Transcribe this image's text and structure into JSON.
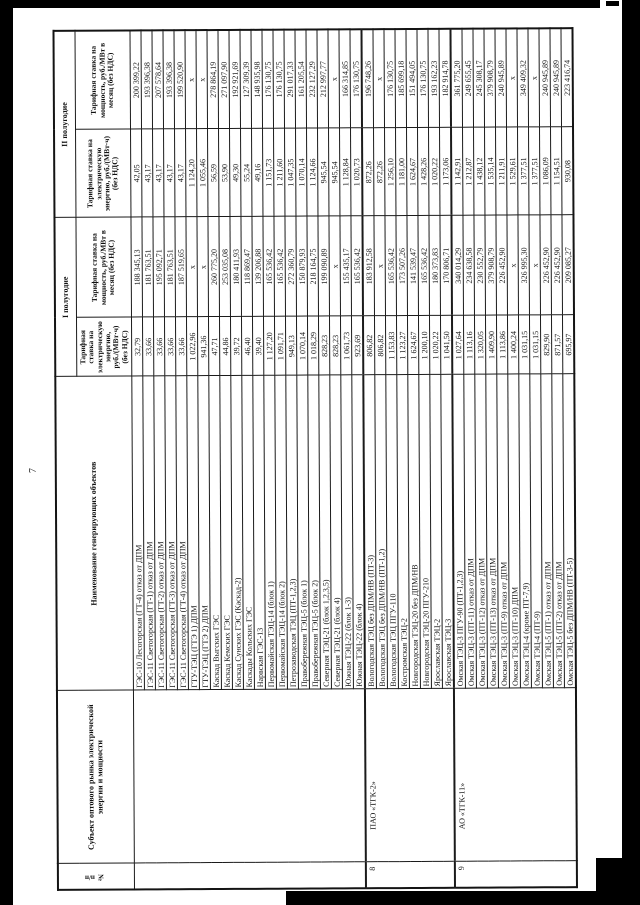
{
  "page": {
    "number": "7"
  },
  "colors": {
    "paper": "#ffffff",
    "ink": "#1b1b1b",
    "scan_edge": "#000000"
  },
  "table": {
    "headers": {
      "num": "№ п/п",
      "subject": "Субъект оптового рынка электрической энергии и мощности",
      "object": "Наименование генерирующих объектов",
      "half1": "I полугодие",
      "half2": "II полугодие",
      "energy_rate": "Тарифная ставка на электрическую энергию, руб./(МВт·ч) (без НДС)",
      "capacity_rate": "Тарифная ставка на мощность, руб./МВт в месяц (без НДС)"
    },
    "groups": [
      {
        "num": "",
        "subject": "",
        "rows": [
          {
            "name": "ГЭС-10 Лесогорская (ГТ-4) отказ от ДПМ",
            "e1": "32,79",
            "c1": "188 345,13",
            "e2": "42,05",
            "c2": "200 399,22"
          },
          {
            "name": "ГЭС-11 Светогорская (ГТ-1) отказ от ДПМ",
            "e1": "33,66",
            "c1": "181 763,51",
            "e2": "43,17",
            "c2": "193 396,38"
          },
          {
            "name": "ГЭС-11 Светогорская (ГТ-2) отказ от ДПМ",
            "e1": "33,66",
            "c1": "195 092,71",
            "e2": "43,17",
            "c2": "207 578,64"
          },
          {
            "name": "ГЭС-11 Светогорская (ГТ-3) отказ от ДПМ",
            "e1": "33,66",
            "c1": "181 763,51",
            "e2": "43,17",
            "c2": "193 396,38"
          },
          {
            "name": "ГЭС-11 Светогорская (ГТ-4) отказ от ДПМ",
            "e1": "33,66",
            "c1": "187 519,65",
            "e2": "43,17",
            "c2": "199 520,90"
          },
          {
            "name": "ГТУ-ТЭЦ (ГТЭ 1) ДПМ",
            "e1": "1 022,96",
            "c1": "х",
            "e2": "1 124,20",
            "c2": "х"
          },
          {
            "name": "ГТУ-ТЭЦ (ГТЭ 2) ДПМ",
            "e1": "941,36",
            "c1": "х",
            "e2": "1 055,46",
            "c2": "х"
          },
          {
            "name": "Каскад Выгских ГЭС",
            "e1": "47,71",
            "c1": "260 775,20",
            "e2": "56,59",
            "c2": "278 864,19"
          },
          {
            "name": "Каскад Кемских ГЭС",
            "e1": "44,86",
            "c1": "253 035,08",
            "e2": "53,90",
            "c2": "271 097,90"
          },
          {
            "name": "Каскад Сунских ГЭС (Каскад-2)",
            "e1": "39,72",
            "c1": "180 411,93",
            "e2": "49,30",
            "c2": "192 921,69"
          },
          {
            "name": "Каскады Кольских ГЭС",
            "e1": "46,40",
            "c1": "118 869,47",
            "e2": "55,24",
            "c2": "127 309,39"
          },
          {
            "name": "Нарвская ГЭС-13",
            "e1": "39,40",
            "c1": "139 206,88",
            "e2": "49,16",
            "c2": "148 935,98"
          },
          {
            "name": "Первомайская ТЭЦ-14 (блок 1)",
            "e1": "1 127,20",
            "c1": "165 536,42",
            "e2": "1 151,73",
            "c2": "176 130,75"
          },
          {
            "name": "Первомайская ТЭЦ-14 (блок 2)",
            "e1": "1 091,71",
            "c1": "165 536,42",
            "e2": "1 211,60",
            "c2": "176 130,75"
          },
          {
            "name": "Петрозаводская ТЭЦ (ПТ-1,2,3)",
            "e1": "949,13",
            "c1": "272 360,79",
            "e2": "1 047,35",
            "c2": "291 017,33"
          },
          {
            "name": "Правобережная ТЭЦ-5 (блок 1)",
            "e1": "1 070,14",
            "c1": "150 879,93",
            "e2": "1 070,14",
            "c2": "161 205,54"
          },
          {
            "name": "Правобережная ТЭЦ-5 (блок 2)",
            "e1": "1 018,29",
            "c1": "218 164,75",
            "e2": "1 124,66",
            "c2": "232 127,29"
          },
          {
            "name": "Северная ТЭЦ-21 (блок 1,2,3,5)",
            "e1": "828,23",
            "c1": "199 090,89",
            "e2": "945,54",
            "c2": "212 997,77"
          },
          {
            "name": "Северная ТЭЦ-21 (блок 4)",
            "e1": "828,23",
            "c1": "х",
            "e2": "945,54",
            "c2": "х"
          },
          {
            "name": "Южная ТЭЦ-22 (блок 1-3)",
            "e1": "1 061,73",
            "c1": "155 435,17",
            "e2": "1 128,84",
            "c2": "166 314,85"
          },
          {
            "name": "Южная ТЭЦ-22 (блок 4)",
            "e1": "923,69",
            "c1": "165 536,42",
            "e2": "1 020,73",
            "c2": "176 130,75"
          }
        ]
      },
      {
        "num": "8",
        "subject": "ПАО «ТГК-2»",
        "rows": [
          {
            "name": "Вологодская ТЭЦ без ДПМ/НВ (ПТ-3)",
            "e1": "806,82",
            "c1": "183 912,58",
            "e2": "872,26",
            "c2": "196 748,26"
          },
          {
            "name": "Вологодская ТЭЦ без ДПМ/НВ (ПТ-1,2)",
            "e1": "806,82",
            "c1": "х",
            "e2": "872,26",
            "c2": "х"
          },
          {
            "name": "Вологодская ТЭЦ ПГУ-110",
            "e1": "1 153,83",
            "c1": "165 536,42",
            "e2": "1 256,10",
            "c2": "176 130,75"
          },
          {
            "name": "Костромская ТЭЦ-2",
            "e1": "1 123,27",
            "c1": "173 507,26",
            "e2": "1 181,00",
            "c2": "185 699,18"
          },
          {
            "name": "Новгородская ТЭЦ-20 без ДПМ/НВ",
            "e1": "1 624,67",
            "c1": "141 539,47",
            "e2": "1 624,67",
            "c2": "151 494,05"
          },
          {
            "name": "Новгородская ТЭЦ-20 ПГУ-210",
            "e1": "1 200,10",
            "c1": "165 536,42",
            "e2": "1 428,26",
            "c2": "176 130,75"
          },
          {
            "name": "Ярославская ТЭЦ-2",
            "e1": "1 020,22",
            "c1": "180 373,83",
            "e2": "1 020,22",
            "c2": "193 162,23"
          },
          {
            "name": "Ярославская ТЭЦ-3",
            "e1": "1 041,50",
            "c1": "170 806,71",
            "e2": "1 173,06",
            "c2": "182 914,78"
          }
        ]
      },
      {
        "num": "9",
        "subject": "АО «ТГК-11»",
        "rows": [
          {
            "name": "Омская ТЭЦ-3 ПГУ-90 (ПТ-1,2,3)",
            "e1": "1 027,64",
            "c1": "340 014,29",
            "e2": "1 142,91",
            "c2": "361 775,20"
          },
          {
            "name": "Омская ТЭЦ-3 (ПТ-11) отказ от ДПМ",
            "e1": "1 113,16",
            "c1": "234 638,58",
            "e2": "1 212,87",
            "c2": "249 655,45"
          },
          {
            "name": "Омская ТЭЦ-3 (ПТ-12) отказ от ДПМ",
            "e1": "1 320,05",
            "c1": "230 552,79",
            "e2": "1 438,12",
            "c2": "245 308,17"
          },
          {
            "name": "Омская ТЭЦ-3 (ПТ-13) отказ от ДПМ",
            "e1": "1 409,90",
            "c1": "379 908,79",
            "e2": "1 535,14",
            "c2": "379 908,79"
          },
          {
            "name": "Омская ТЭЦ-3 (ПТ-9) отказ от ДПМ",
            "e1": "1 113,86",
            "c1": "226 452,90",
            "e2": "1 211,91",
            "c2": "240 945,89"
          },
          {
            "name": "Омская ТЭЦ-3 (ПТ-10) ДПМ",
            "e1": "1 400,24",
            "c1": "х",
            "e2": "1 529,61",
            "c2": "х"
          },
          {
            "name": "Омская ТЭЦ-4 (кроме ПТ-7,9)",
            "e1": "1 031,15",
            "c1": "326 995,30",
            "e2": "1 377,51",
            "c2": "349 409,32"
          },
          {
            "name": "Омская ТЭЦ-4 (ПТ-9)",
            "e1": "1 031,15",
            "c1": "х",
            "e2": "1 377,51",
            "c2": "х"
          },
          {
            "name": "Омская ТЭЦ-5 (ПТ-1) отказ от ДПМ",
            "e1": "829,90",
            "c1": "226 452,90",
            "e2": "1 086,09",
            "c2": "240 945,89"
          },
          {
            "name": "Омская ТЭЦ-5 (ПТ-2) отказ от ДПМ",
            "e1": "871,57",
            "c1": "226 452,90",
            "e2": "1 154,51",
            "c2": "240 945,89"
          },
          {
            "name": "Омская ТЭЦ-5 без ДПМ/НВ (ПТ-3-5)",
            "e1": "695,97",
            "c1": "209 085,27",
            "e2": "930,08",
            "c2": "223 416,74"
          }
        ]
      }
    ]
  }
}
